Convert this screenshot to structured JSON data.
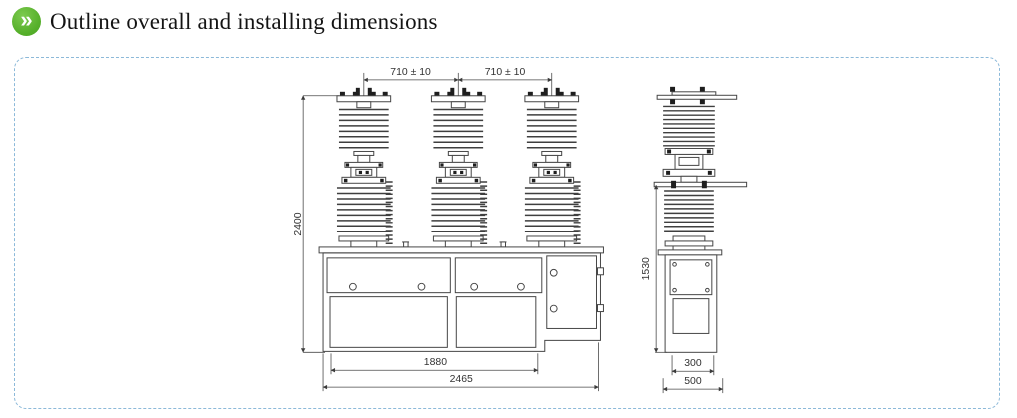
{
  "header": {
    "icon": {
      "name": "double-chevron-right",
      "glyph": "»",
      "bg_color": "#55af2a"
    },
    "title": "Outline overall and installing dimensions"
  },
  "panel": {
    "border_color": "#8cb9d9",
    "border_style": "dashed-rounded"
  },
  "drawing": {
    "stroke_color": "#454545",
    "front_view": {
      "dim_phase_spacing_left": "710 ± 10",
      "dim_phase_spacing_right": "710 ± 10",
      "dim_height": "2400",
      "dim_base_width": "1880",
      "dim_overall_width": "2465"
    },
    "side_view": {
      "dim_height": "1530",
      "dim_cabinet_width": "300",
      "dim_overall_depth": "500"
    }
  }
}
